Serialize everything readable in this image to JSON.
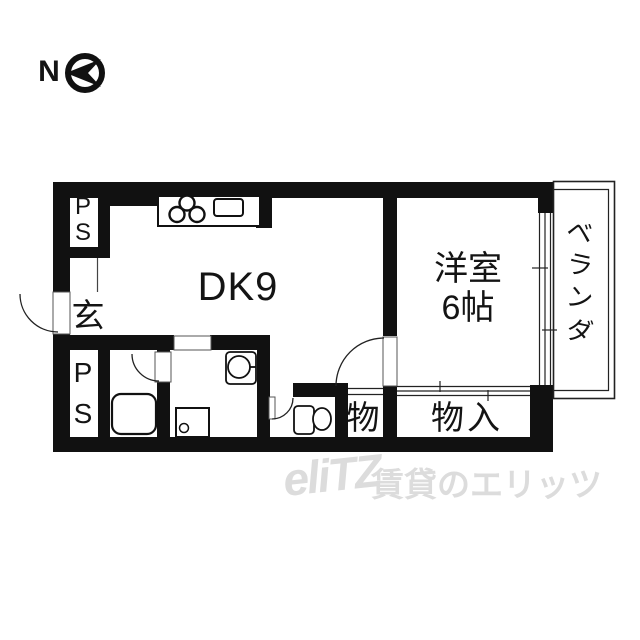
{
  "compass": {
    "north_label": "N"
  },
  "rooms": {
    "ps_top": {
      "label": "PS"
    },
    "ps_bottom": {
      "label": "PS"
    },
    "genkan": {
      "label": "玄"
    },
    "dk": {
      "label": "DK9"
    },
    "western_room": {
      "label_line1": "洋室",
      "label_line2": "6帖"
    },
    "storage_small": {
      "label": "物"
    },
    "storage_closet": {
      "label": "物入"
    },
    "veranda": {
      "label": "ベランダ"
    }
  },
  "watermark": {
    "logo": "eliTZ",
    "text": "賃貸のエリッツ"
  },
  "colors": {
    "wall": "#111111",
    "line": "#222222",
    "watermark": "#dcdcdc",
    "background": "#ffffff"
  }
}
